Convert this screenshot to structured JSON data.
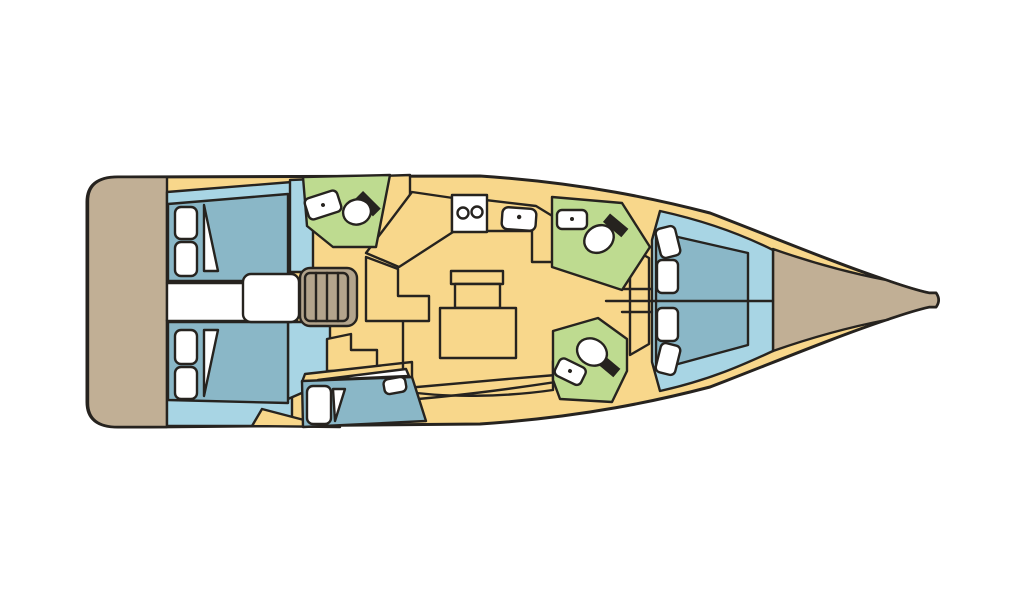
{
  "meta": {
    "title": "Sailing yacht interior layout plan, top view, bow to the right",
    "type": "floor-plan-diagram"
  },
  "colors": {
    "background": "#ffffff",
    "outline": "#26231f",
    "hull_yellow": "#f8d78b",
    "platform_tan": "#c1af95",
    "stairs_tan": "#b3a48c",
    "cabin_blue": "#a8d5e4",
    "berth_blue": "#8ab7c7",
    "bathroom_green": "#bedb90",
    "fixture_white": "#ffffff"
  },
  "areas": [
    {
      "id": "swim-platform",
      "fill": "platform_tan",
      "position": "stern (far left)"
    },
    {
      "id": "aft-cabin-upper",
      "fill": "cabin_blue",
      "berth": "double",
      "pillows": 2,
      "sheet_corner": 1
    },
    {
      "id": "aft-cabin-lower",
      "fill": "cabin_blue",
      "berth": "double",
      "pillows": 2,
      "sheet_corner": 1
    },
    {
      "id": "companionway",
      "fill": "fixture_white",
      "steps": 4
    },
    {
      "id": "head-aft",
      "fill": "bathroom_green",
      "fixtures": [
        "sink",
        "toilet"
      ]
    },
    {
      "id": "saloon-galley",
      "fill": "hull_yellow",
      "fixtures": [
        "double-basin sink",
        "stove",
        "table"
      ]
    },
    {
      "id": "crew-berth-lower",
      "fill": "berth_blue",
      "pillows": 2,
      "sheet_corner": 1
    },
    {
      "id": "head-forward-upper",
      "fill": "bathroom_green",
      "fixtures": [
        "sink",
        "toilet"
      ]
    },
    {
      "id": "head-forward-lower",
      "fill": "bathroom_green",
      "fixtures": [
        "toilet",
        "sink"
      ]
    },
    {
      "id": "fore-cabin",
      "fill": "cabin_blue",
      "berth": "V-berth split in two",
      "pillows": 4
    },
    {
      "id": "bow-deck",
      "fill": "platform_tan",
      "position": "bow (far right, tapers to tip)"
    }
  ]
}
